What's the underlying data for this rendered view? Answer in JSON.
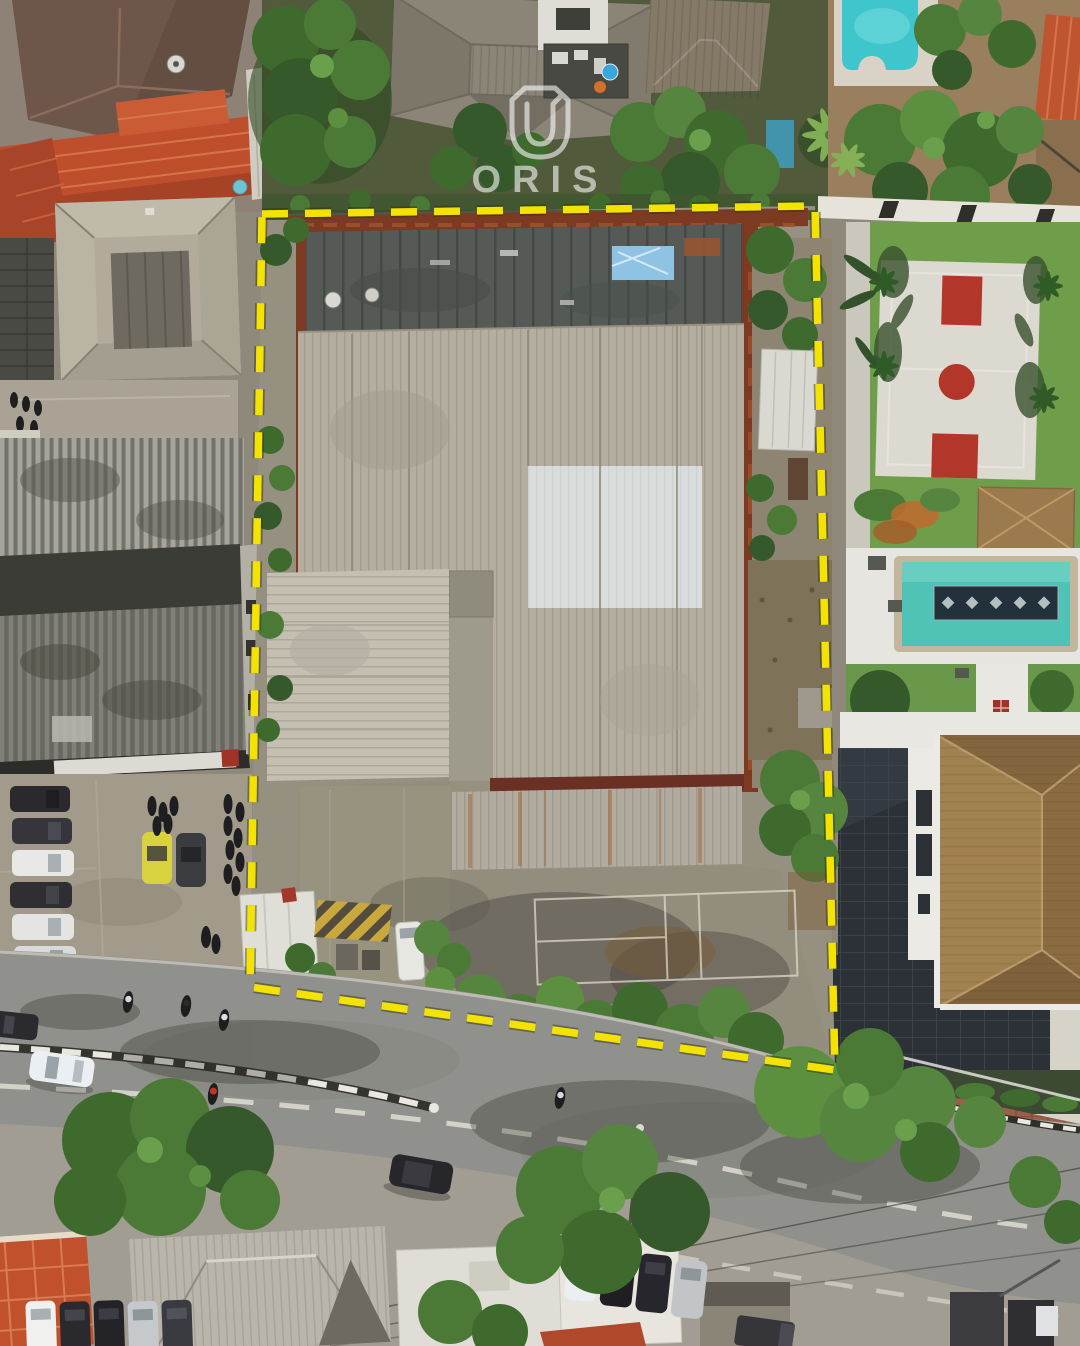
{
  "watermark": {
    "brand_text": "ORIS",
    "logo": "oris-shield-icon",
    "color": "#ffffff"
  },
  "overlay": {
    "boundary_color": "#f4e300",
    "boundary_casing_color": "#2a2f0e",
    "style": "dashed-outline"
  },
  "palette": {
    "pool_teal": "#3fc6cd",
    "lap_pool_teal": "#4fc4b6",
    "court_red": "#b2372a",
    "terracotta_roof": "#bf4f2c",
    "warehouse_roof": "#b5aea0",
    "warehouse_bright_panel": "#d9dedd",
    "rust_frame": "#7c3a23",
    "dark_tile_roof": "#2b3137",
    "big_house_roof": "#97774c",
    "asphalt": "#90908c",
    "lawn_green": "#6f9e4b",
    "yellow_car": "#d8d23e"
  }
}
